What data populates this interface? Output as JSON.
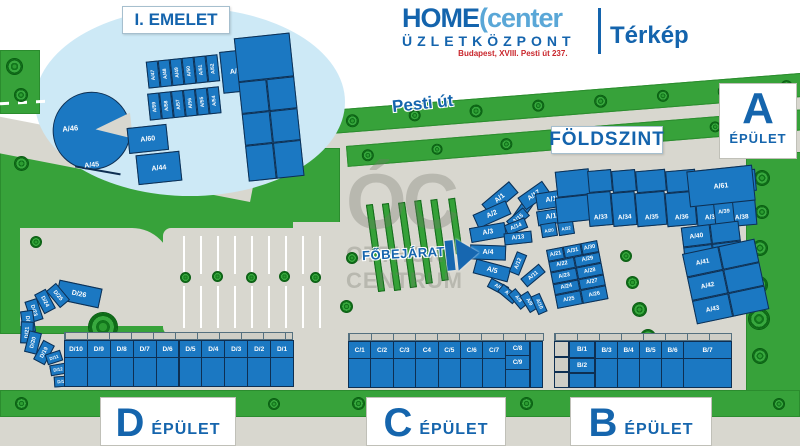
{
  "header": {
    "brand_home": "HOME",
    "brand_center": "(center",
    "brand_subtitle": "ÜZLETKÖZPONT",
    "brand_address": "Budapest, XVIII. Pesti út 237.",
    "map_tab": "Térkép"
  },
  "labels": {
    "inset_title": "I. EMELET",
    "street": "Pesti út",
    "ground_floor": "FÖLDSZINT",
    "main_entrance": "FŐBEJÁRAT",
    "building_word": "ÉPÜLET"
  },
  "watermark": {
    "initials": "ÓC",
    "line1": "OTTHON",
    "line2": "CENTRUM"
  },
  "colors": {
    "building_fill": "#1b78c2",
    "building_border": "#0e2f52",
    "accent_blue": "#1464ad",
    "logo_light_blue": "#5aa7d7",
    "address_red": "#c9252b",
    "grass_green": "#37a23a",
    "path_gray": "#d8d7cf",
    "inset_blob": "#cde9f6"
  },
  "inset": {
    "pacman_units": [
      "A/46",
      "A/45"
    ],
    "mid_units": [
      "A/60",
      "A/44"
    ],
    "strip_top": [
      "A/47",
      "A/48",
      "A/49",
      "A/50",
      "A/51",
      "A/52"
    ],
    "strip_bottom": [
      "A/59",
      "A/58",
      "A/57",
      "A/56",
      "A/55",
      "A/54"
    ],
    "corner_unit": "A/53"
  },
  "building_a": {
    "letter": "A",
    "arc_outer": [
      "A/1",
      "A/2",
      "A/3",
      "A/4",
      "A/5"
    ],
    "arc_inner_top": [
      "A/16",
      "A/15",
      "A/14",
      "A/13"
    ],
    "arc_inner_bottom": [
      "A/12",
      "A/11",
      "A/6",
      "A/7",
      "A/8",
      "A/9",
      "A/10"
    ],
    "mid_column": [
      "A/17",
      "A/18",
      "A/19",
      "A/20",
      "A/32"
    ],
    "top_row": [
      "A/33",
      "A/34",
      "A/35",
      "A/36",
      "A/37",
      "A/38"
    ],
    "top_row_end": "A/39",
    "top_right": "A/61",
    "block_rows": [
      [
        "A/21",
        "A/31",
        "A/30"
      ],
      [
        "A/22",
        "A/29"
      ],
      [
        "A/23",
        "A/28"
      ],
      [
        "A/24",
        "A/27"
      ],
      [
        "A/25",
        "A/26"
      ]
    ],
    "grid_unit": "A/40",
    "right_column": [
      "A/41",
      "A/42",
      "A/43"
    ]
  },
  "building_b": {
    "letter": "B",
    "stack": [
      "B/1",
      "B/2"
    ],
    "row": [
      "B/3",
      "B/4",
      "B/5",
      "B/6"
    ],
    "wide_unit": "B/7"
  },
  "building_c": {
    "letter": "C",
    "row": [
      "C/1",
      "C/2",
      "C/3",
      "C4",
      "C/5",
      "C/6",
      "C/7"
    ],
    "stack": [
      "C/8",
      "C/9"
    ]
  },
  "building_d": {
    "letter": "D",
    "arc": [
      "D/26",
      "D/25",
      "D/24",
      "D/23",
      "D/22",
      "D/21",
      "D/20",
      "D/19"
    ],
    "stack": [
      "D/11",
      "D/12",
      "D/13"
    ],
    "row": [
      "D/10",
      "D/9",
      "D/8",
      "D/7",
      "D/6",
      "D/5",
      "D/4",
      "D/3",
      "D/2",
      "D/1"
    ]
  }
}
